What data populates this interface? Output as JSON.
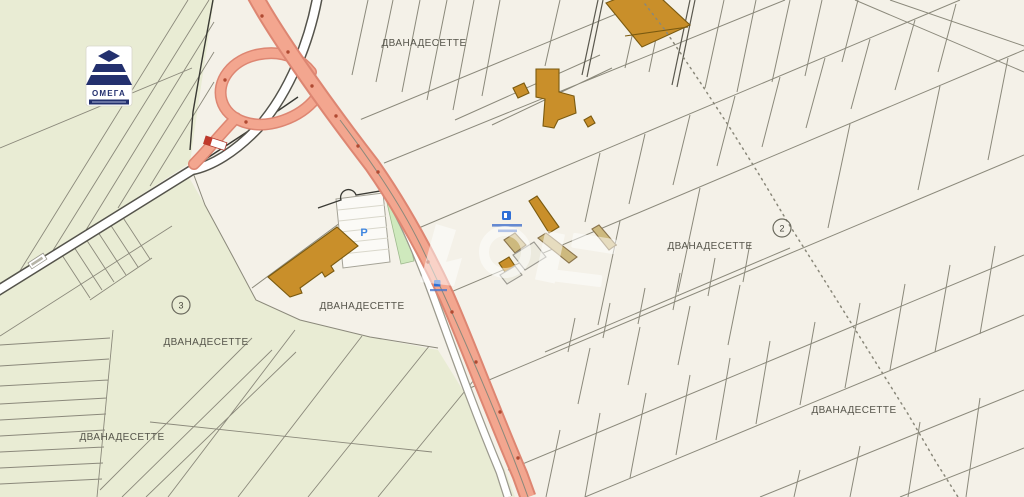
{
  "map": {
    "region_labels": [
      {
        "text": "ДВАНАДЕСЕТТЕ"
      },
      {
        "text": "ДВАНАДЕСЕТТЕ"
      },
      {
        "text": "ДВАНАДЕСЕТТЕ"
      },
      {
        "text": "ДВАНАДЕСЕТТЕ"
      },
      {
        "text": "ДВАНАДЕСЕТТЕ"
      },
      {
        "text": "ДВАНАДЕСЕТТЕ"
      }
    ],
    "parcel_markers": [
      {
        "value": "3"
      },
      {
        "value": "2"
      }
    ],
    "parking_symbol": "P",
    "logo": {
      "text": "ОМЕГА"
    },
    "colors": {
      "parcel_fill_light": "#f4f1e8",
      "parcel_fill_green": "#e9ecd4",
      "parcel_line": "#8b897b",
      "road_fill": "#f3a68f",
      "road_casing": "#dd8672",
      "secondary_road_fill": "#ffffff",
      "secondary_road_casing": "#54534b",
      "building_fill": "#c98f2a",
      "building_outline": "#7a5a10",
      "building_tan": "#cdb97e",
      "green_strip": "#cfe9bd",
      "poi_blue": "#2f6fd6",
      "logo_navy": "#23306e"
    }
  }
}
